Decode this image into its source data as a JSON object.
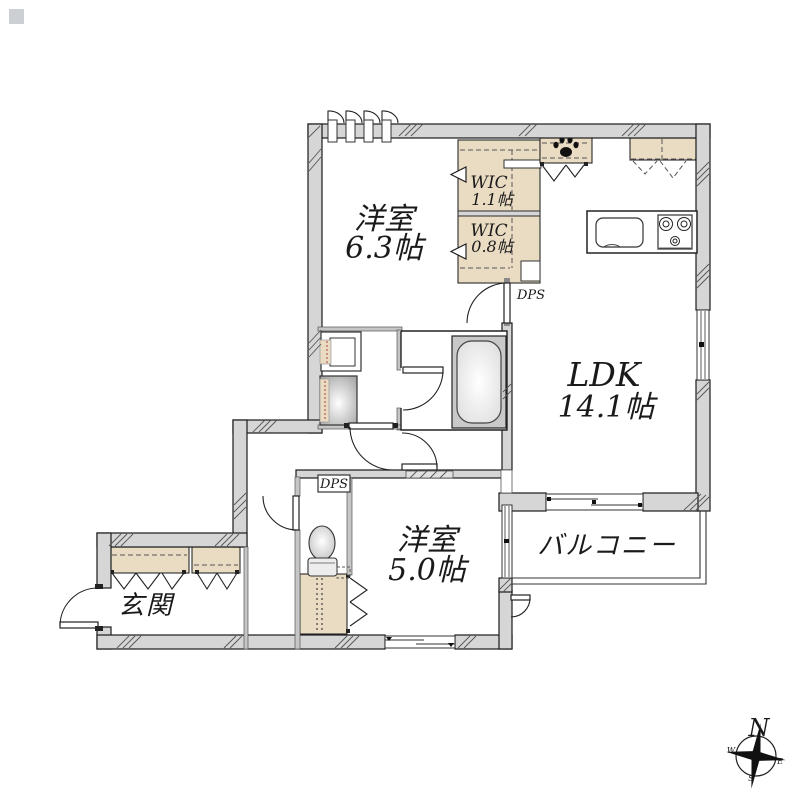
{
  "floorplan": {
    "rooms": [
      {
        "key": "bedroom-63",
        "name": "洋室",
        "size": "6.3帖"
      },
      {
        "key": "wic-11",
        "name": "WIC",
        "size": "1.1帖"
      },
      {
        "key": "wic-08",
        "name": "WIC",
        "size": "0.8帖"
      },
      {
        "key": "ldk",
        "name": "LDK",
        "size": "14.1帖"
      },
      {
        "key": "bedroom-50",
        "name": "洋室",
        "size": "5.0帖"
      },
      {
        "key": "balcony",
        "name": "バルコニー",
        "size": ""
      },
      {
        "key": "entrance",
        "name": "玄関",
        "size": ""
      }
    ],
    "pipe_shafts": [
      {
        "label": "DPS"
      },
      {
        "label": "DPS"
      }
    ],
    "compass": {
      "north": "N",
      "east": "E",
      "south": "S",
      "west": "W"
    },
    "colors": {
      "wall_fill": "#d6d6d6",
      "closet_fill": "#eadcc3",
      "fixture_gray": "#c9c9c9",
      "line": "#1a1a1a",
      "background": "#ffffff"
    }
  }
}
